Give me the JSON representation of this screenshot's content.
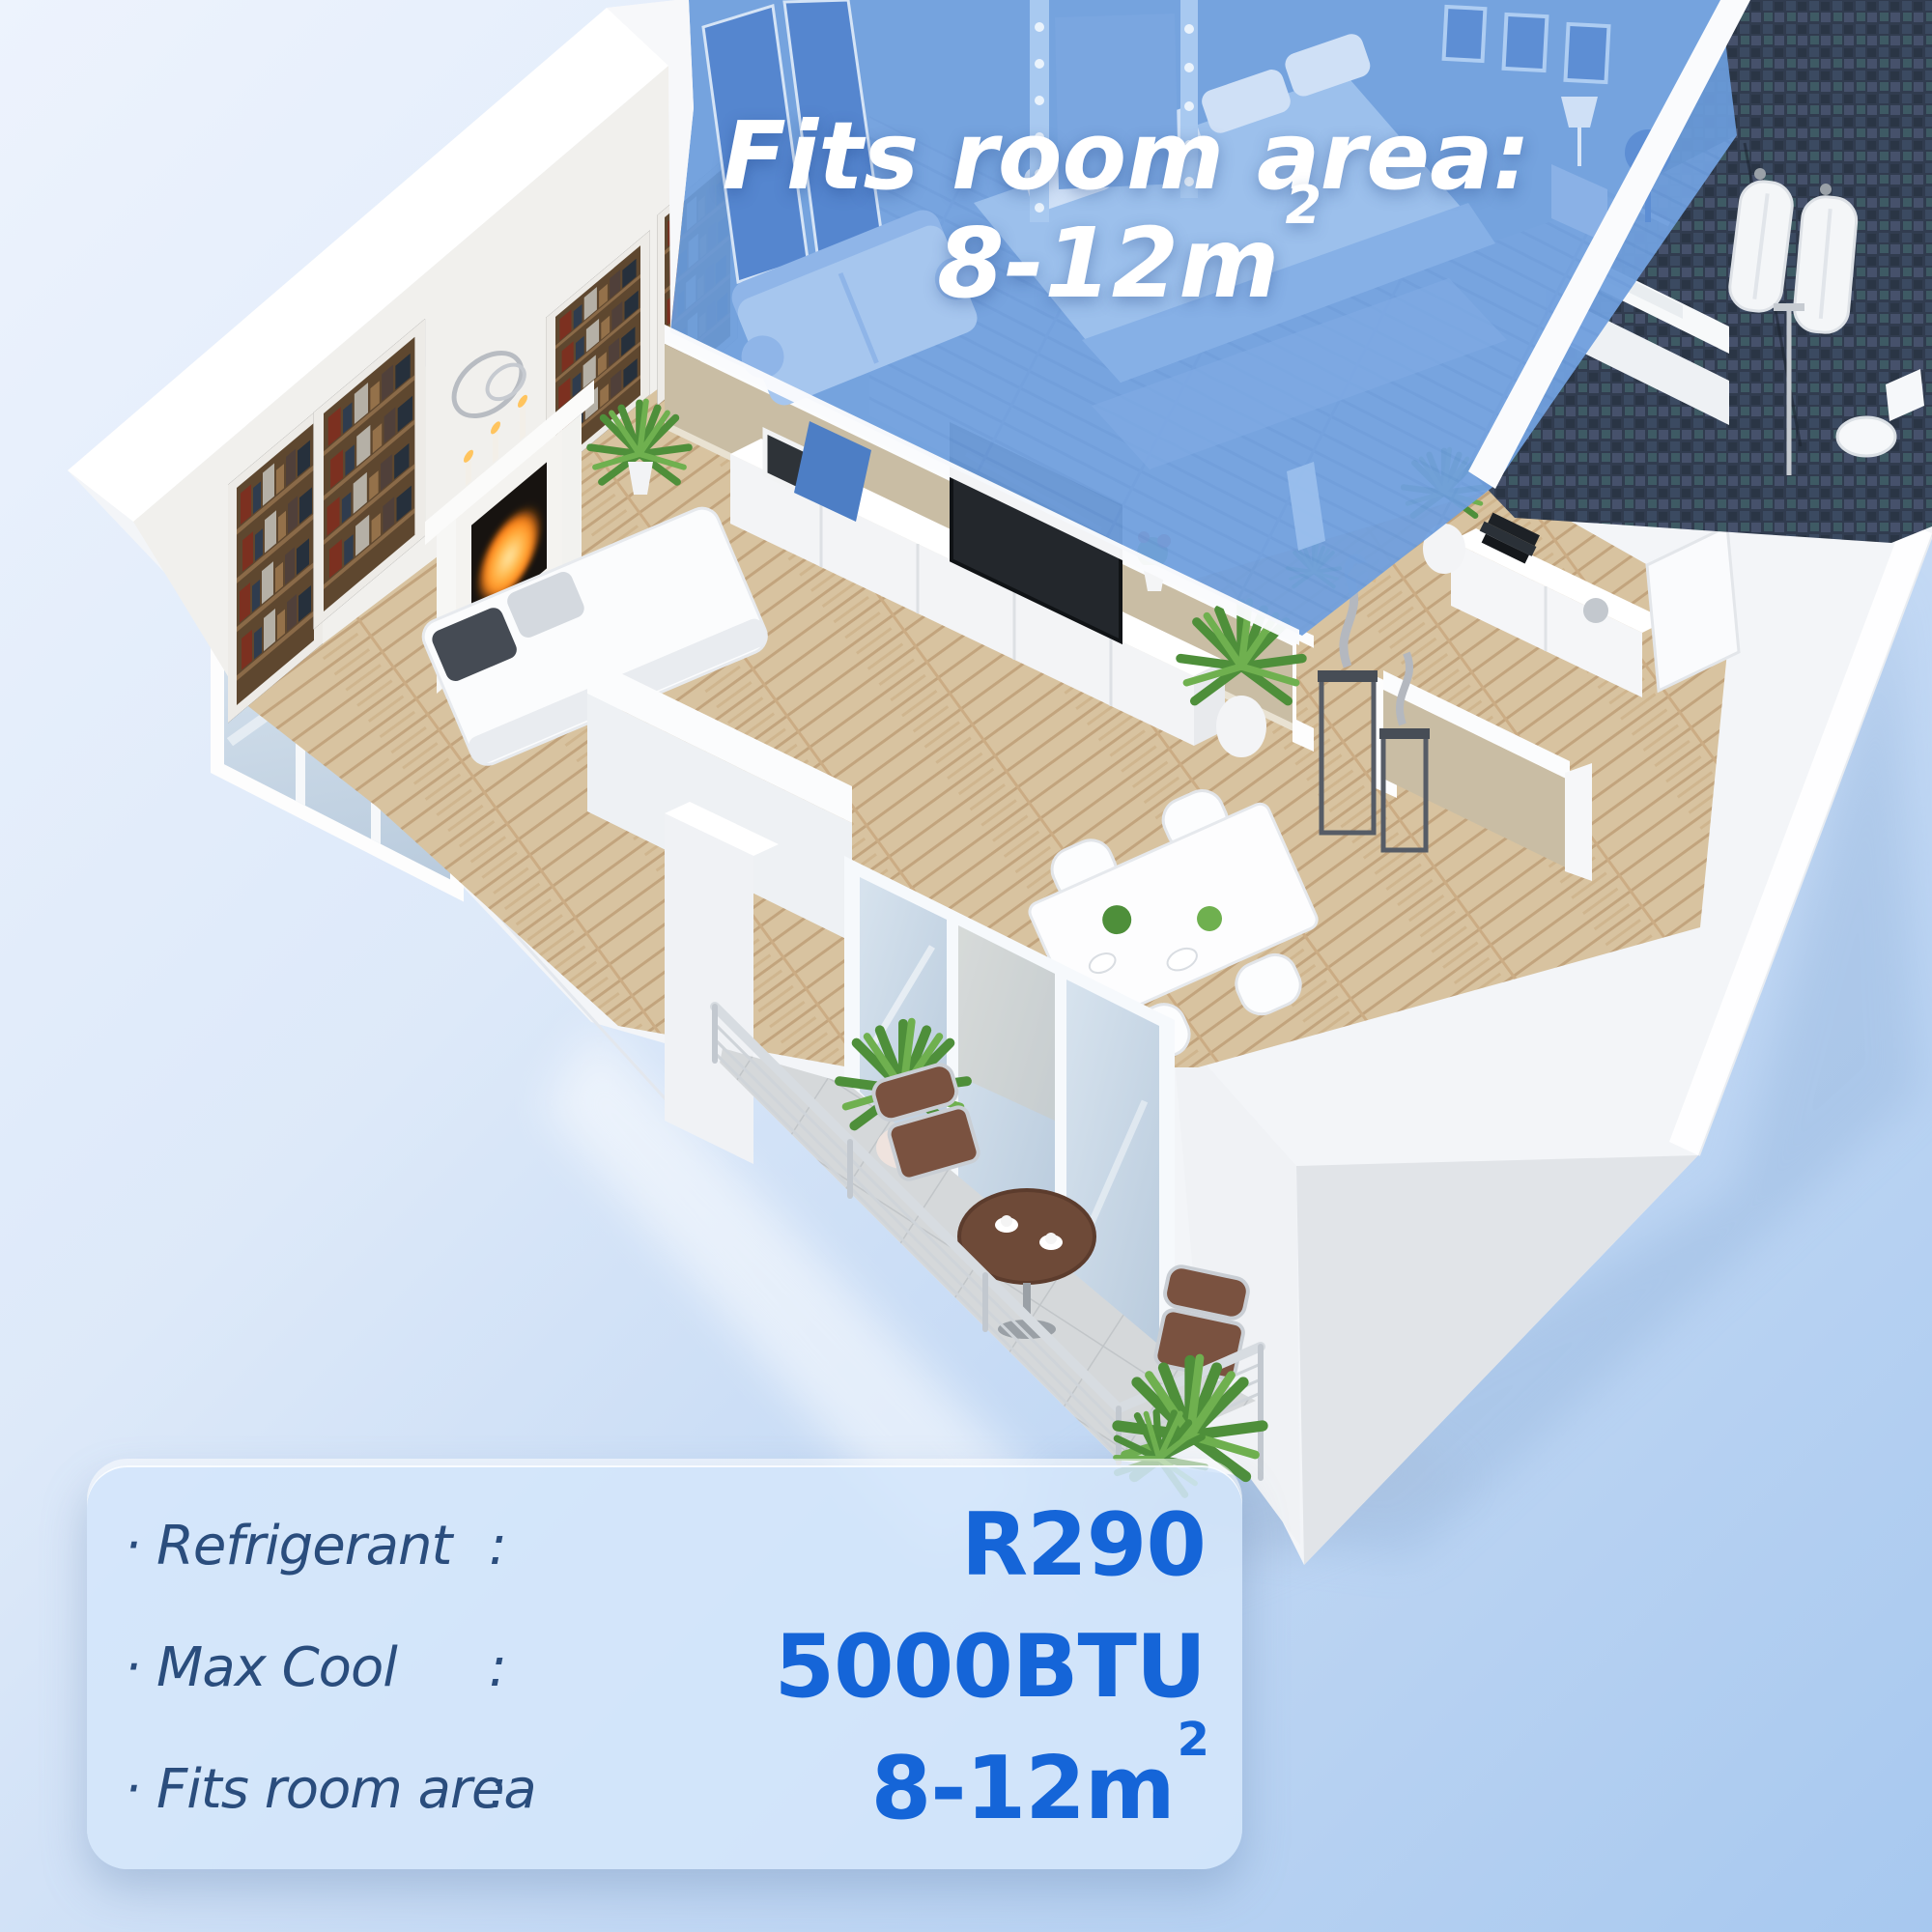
{
  "scene": {
    "type": "isometric-apartment-cutaway-render",
    "highlighted_room": "bedroom",
    "rooms_visible": [
      "living-room",
      "bedroom",
      "bathroom",
      "dining-area",
      "balcony"
    ]
  },
  "overlay_title": {
    "line1": "Fits room area:",
    "value": "8-12m",
    "value_superscript": "2"
  },
  "spec_panel": {
    "rows": [
      {
        "bullet": "·",
        "label": "Refrigerant",
        "colon": ":",
        "value": "R290",
        "value_superscript": ""
      },
      {
        "bullet": "·",
        "label": "Max Cool",
        "colon": ":",
        "value": "5000BTU",
        "value_superscript": ""
      },
      {
        "bullet": "·",
        "label": "Fits room area",
        "colon": ":",
        "value": "8-12m",
        "value_superscript": "2"
      }
    ]
  },
  "colors": {
    "background_top": "#edf3fd",
    "background_bottom": "#a7c8ef",
    "highlight_blue": "#6b9cdc",
    "overlay_text": "#ffffff",
    "panel_background": "rgba(212,230,250,0.88)",
    "label_navy": "#2a4d7d",
    "value_blue": "#1565d8"
  }
}
